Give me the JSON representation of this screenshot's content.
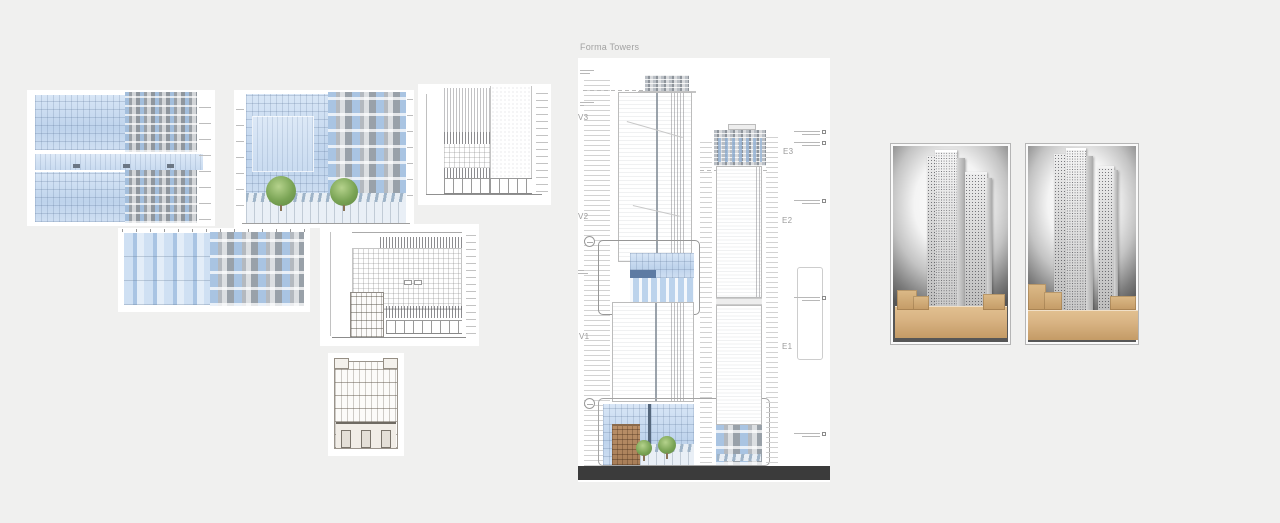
{
  "canvas": {
    "board_title": "Forma Towers"
  },
  "board": {
    "v_levels": [
      {
        "label": "V3"
      },
      {
        "label": "V2"
      },
      {
        "label": "V1"
      }
    ],
    "e_levels": [
      {
        "label": "E3"
      },
      {
        "label": "E2"
      },
      {
        "label": "E1"
      }
    ]
  },
  "colors": {
    "canvas_bg": "#f0f0ef",
    "card_bg": "#ffffff",
    "board_title_gray": "#a2a2a2",
    "level_label_gray": "#9b9b9b",
    "ground_band": "#3b3b3b",
    "glass_blue": "#c7daf0",
    "facade_gray": "#9aa0a6",
    "wood_tan": "#d9b484",
    "heritage_brick": "#b08a62"
  }
}
